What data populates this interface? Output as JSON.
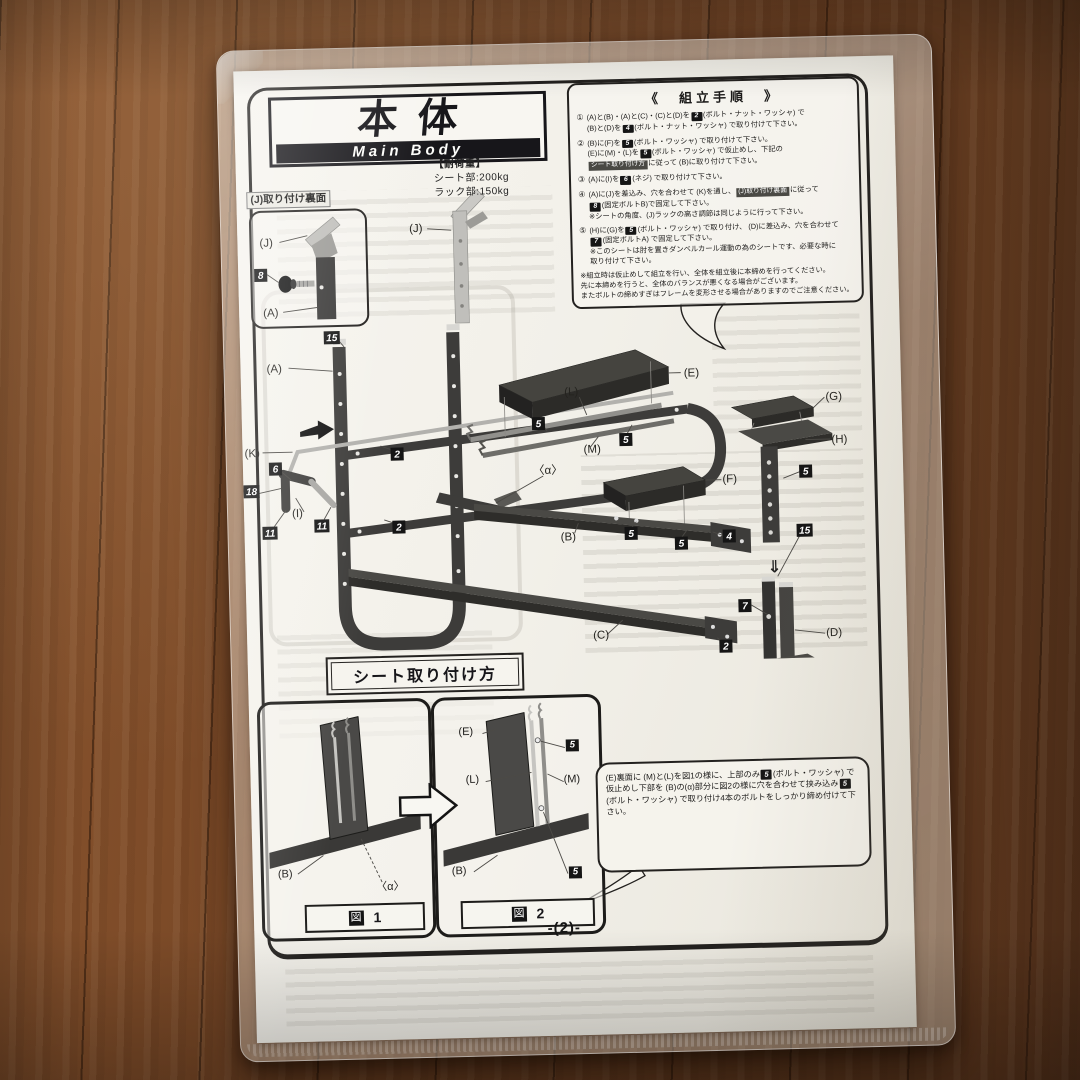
{
  "page": {
    "number": "-(2)-"
  },
  "title": {
    "main": "本体",
    "sub": "Main Body"
  },
  "load": {
    "heading": "【耐荷重】",
    "seat": "シート部:200kg",
    "rack": "ラック部:150kg"
  },
  "assembly": {
    "heading": "《　組立手順　》",
    "steps": [
      {
        "num": "①",
        "segs": [
          {
            "t": "(A)と(B)・(A)と(C)・(C)と(D)を"
          },
          {
            "n": "2"
          },
          {
            "t": "(ボルト・ナット・ワッシャ) で"
          },
          {
            "br": true
          },
          {
            "t": "(B)と(D)を"
          },
          {
            "n": "4"
          },
          {
            "t": "(ボルト・ナット・ワッシャ) で取り付けて下さい。"
          }
        ]
      },
      {
        "num": "②",
        "segs": [
          {
            "t": "(B)に(F)を"
          },
          {
            "n": "5"
          },
          {
            "t": "(ボルト・ワッシャ) で取り付けて下さい。"
          },
          {
            "br": true
          },
          {
            "t": "(E)に(M)・(L)を"
          },
          {
            "n": "5"
          },
          {
            "t": "(ボルト・ワッシャ) で仮止めし、下記の"
          },
          {
            "br": true
          },
          {
            "r": "シート取り付け方"
          },
          {
            "t": "に従って (B)に取り付けて下さい。"
          }
        ]
      },
      {
        "num": "③",
        "segs": [
          {
            "t": "(A)に(I)を"
          },
          {
            "n": "6"
          },
          {
            "t": "(ネジ) で取り付けて下さい。"
          }
        ]
      },
      {
        "num": "④",
        "segs": [
          {
            "t": "(A)に(J)を差込み、穴を合わせて (K)を通し、"
          },
          {
            "r": "(J)取り付け裏面"
          },
          {
            "t": "に従って"
          },
          {
            "br": true
          },
          {
            "n": "8"
          },
          {
            "t": "(固定ボルトB)で固定して下さい。"
          },
          {
            "br": true
          },
          {
            "t": "※シートの角度、(J)ラックの高さ調節は同じように行って下さい。"
          }
        ]
      },
      {
        "num": "⑤",
        "segs": [
          {
            "t": "(H)に(G)を"
          },
          {
            "n": "5"
          },
          {
            "t": "(ボルト・ワッシャ) で取り付け、 (D)に差込み、穴を合わせて"
          },
          {
            "br": true
          },
          {
            "n": "7"
          },
          {
            "t": "(固定ボルトA) で固定して下さい。"
          },
          {
            "br": true
          },
          {
            "t": "※このシートは肘を置きダンベルカール運動の為のシートです、必要な時に"
          },
          {
            "br": true
          },
          {
            "t": "取り付けて下さい。"
          }
        ]
      }
    ],
    "notes": "※組立時は仮止めして組立を行い、全体を組立後に本締めを行ってください。\n先に本締めを行うと、全体のバランスが悪くなる場合がございます。\nまたボルトの締めすぎはフレームを変形させる場合がありますのでご注意ください。"
  },
  "jbox": {
    "heading": "(J)取り付け裏面",
    "labels": {
      "j": "(J)",
      "a": "(A)",
      "n8": "8"
    }
  },
  "diagram": {
    "labels": {
      "j": "(J)",
      "a": "(A)",
      "k": "(K)",
      "i": "(I)",
      "e": "(E)",
      "l": "(L)",
      "m": "(M)",
      "alpha": "〈α〉",
      "f": "(F)",
      "b": "(B)",
      "g": "(G)",
      "h": "(H)",
      "c": "(C)",
      "d": "(D)"
    },
    "numbers": {
      "n2": "2",
      "n4": "4",
      "n5": "5",
      "n6": "6",
      "n7": "7",
      "n11": "11",
      "n13": "13",
      "n15": "15",
      "n18": "18"
    },
    "arrow_down": "⇓"
  },
  "seat_section": {
    "heading": "シート取り付け方",
    "fig1": {
      "caption_mark": "図",
      "caption_num": "1",
      "labels": {
        "b": "(B)",
        "alpha": "〈α〉"
      }
    },
    "fig2": {
      "caption_mark": "図",
      "caption_num": "2",
      "labels": {
        "e": "(E)",
        "l": "(L)",
        "m": "(M)",
        "b": "(B)",
        "n5": "5"
      }
    },
    "bubble_segs": [
      {
        "t": "(E)裏面に (M)と(L)を図1の様に、上部のみ"
      },
      {
        "n": "5"
      },
      {
        "t": "(ボルト・ワッシャ) で仮止めし下部を (B)の(α)部分に図2の様に穴を合わせて挟み込み"
      },
      {
        "n": "5"
      },
      {
        "t": "(ボルト・ワッシャ) で取り付け4本のボルトをしっかり締め付けて下さい。"
      }
    ]
  }
}
